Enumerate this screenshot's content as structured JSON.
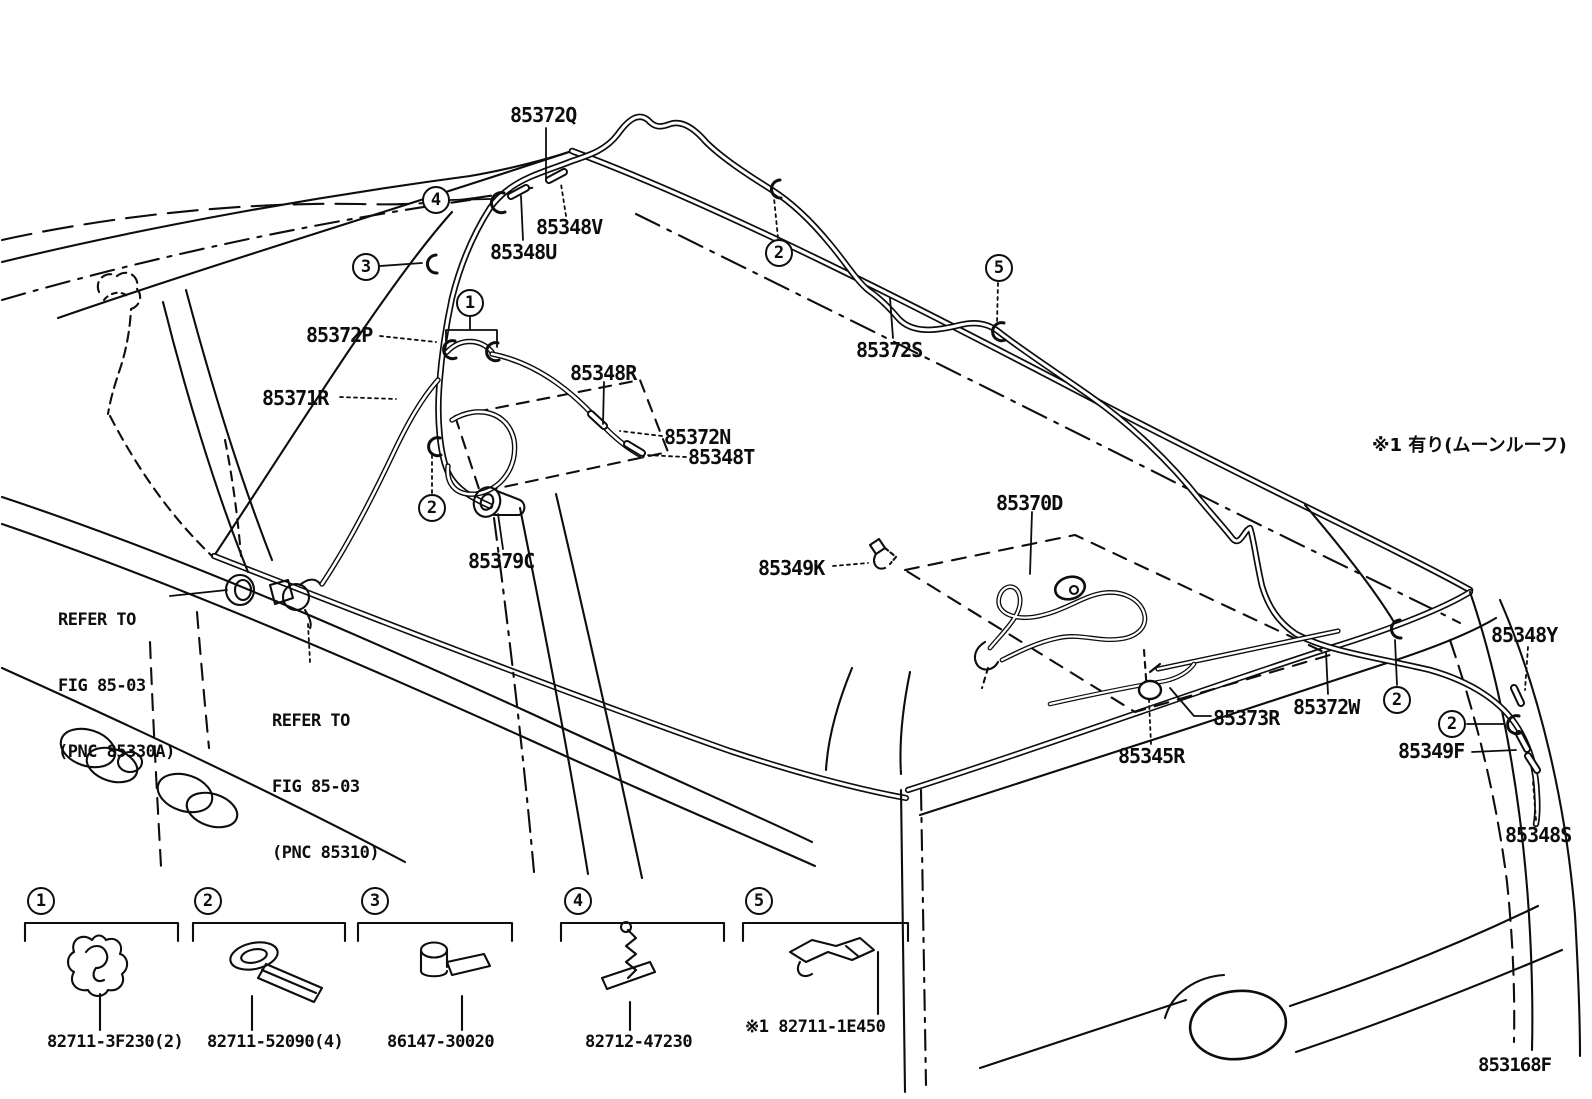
{
  "figure": {
    "note_moonroof": "※1 有り(ムーンルーフ)",
    "figure_code": "853168F"
  },
  "callout_numbers": {
    "n1": "1",
    "n2": "2",
    "n3": "3",
    "n4": "4",
    "n5": "5"
  },
  "part_labels": {
    "p85372q": "85372Q",
    "p85348v": "85348V",
    "p85348u": "85348U",
    "p85372p": "85372P",
    "p85371r": "85371R",
    "p85348r": "85348R",
    "p85372n": "85372N",
    "p85348t": "85348T",
    "p85379c": "85379C",
    "p85372s": "85372S",
    "p85370d": "85370D",
    "p85349k": "85349K",
    "p85345r": "85345R",
    "p85373r": "85373R",
    "p85372w": "85372W",
    "p85348y": "85348Y",
    "p85349f": "85349F",
    "p85348s": "85348S"
  },
  "refer_notes": {
    "left": {
      "line1": "REFER TO",
      "line2": "FIG 85-03",
      "line3": "(PNC 85330A)"
    },
    "right": {
      "line1": "REFER TO",
      "line2": "FIG 85-03",
      "line3": "(PNC 85310)"
    }
  },
  "legend": {
    "items": [
      {
        "number": "1",
        "part_number": "82711-3F230(2)"
      },
      {
        "number": "2",
        "part_number": "82711-52090(4)"
      },
      {
        "number": "3",
        "part_number": "86147-30020"
      },
      {
        "number": "4",
        "part_number": "82712-47230"
      },
      {
        "number": "5",
        "part_number": "※1 82711-1E450"
      }
    ]
  }
}
